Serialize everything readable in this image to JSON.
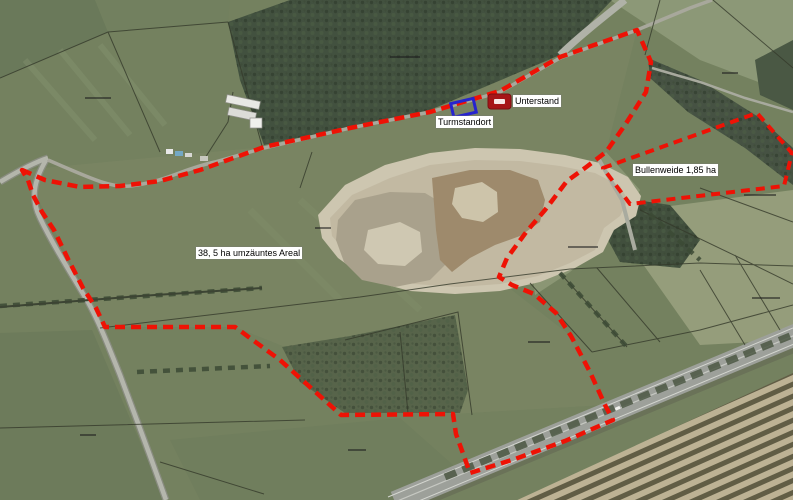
{
  "labels": {
    "turmstandort": "Turmstandort",
    "unterstand": "Unterstand",
    "bullenweide": "Bullenweide 1,85 ha",
    "areal": "38, 5 ha umzäuntes Areal"
  },
  "colors": {
    "boundary_red": "#ee1205",
    "marker_blue": "#2623cf",
    "unterstand_red": "#a61518",
    "label_bg": "#ffffff",
    "label_text": "#000000"
  }
}
